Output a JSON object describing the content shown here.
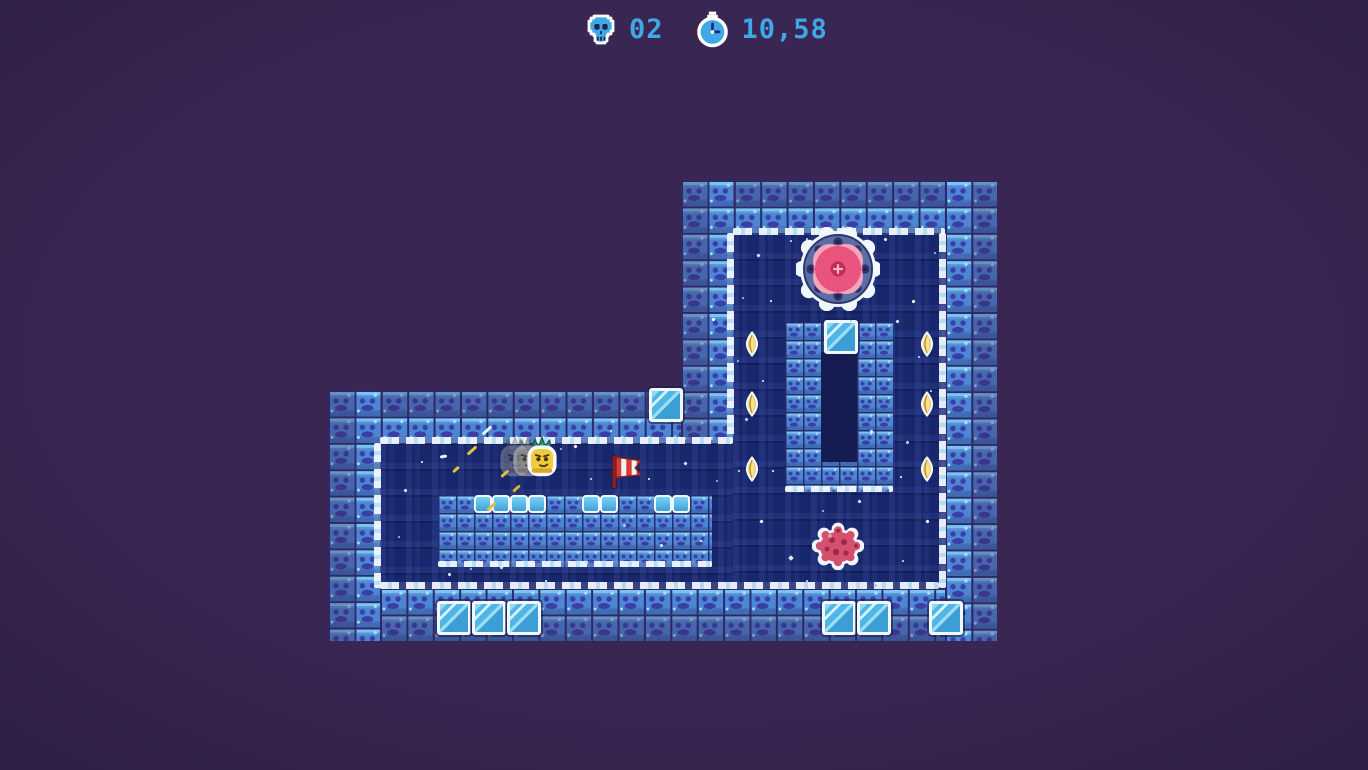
{
  "scene": {
    "width": 1368,
    "height": 770
  },
  "hud": {
    "skull_counter": {
      "icon": "skull-icon",
      "value": "02"
    },
    "timer": {
      "icon": "stopwatch-icon",
      "value": "10,58"
    },
    "text_color": "#3FA8E6"
  },
  "palette": {
    "outside_bg": "#3A2653",
    "room_bg": "#18266B",
    "tile_base": "#4D86D2",
    "tile_light": "#7CC4EE",
    "tile_speck": "#A6E0F6",
    "tile_mark": "#3B3EA6",
    "tile_outer_shade": "rgba(56,36,92,0.32)",
    "grout": "#2A2A70",
    "ice_white": "#F1F7FE",
    "glass_fill": "#4FB6E6",
    "glass_light": "#D6F2FC",
    "coin_gold": "#E7C652",
    "saw_ring": "#5A6EA8",
    "saw_pink": "#E8547E",
    "blob_body": "#D4506E",
    "player_body": "#F2CB3A",
    "flag_red": "#D93A34"
  },
  "level": {
    "rooms": [
      {
        "name": "right-room-interior",
        "x": 733,
        "y": 233,
        "w": 212,
        "h": 355
      },
      {
        "name": "left-room-interior",
        "x": 380,
        "y": 443,
        "w": 353,
        "h": 145
      }
    ],
    "walls": [
      {
        "name": "right-room-top-wall",
        "x": 681,
        "y": 180,
        "w": 316,
        "h": 53,
        "outer": "top"
      },
      {
        "name": "right-room-left-wall",
        "x": 681,
        "y": 180,
        "w": 52,
        "h": 263,
        "outer": "left"
      },
      {
        "name": "right-room-right-wall",
        "x": 945,
        "y": 180,
        "w": 52,
        "h": 461,
        "outer": "right"
      },
      {
        "name": "left-room-top-wall",
        "x": 328,
        "y": 390,
        "w": 353,
        "h": 53,
        "outer": "top"
      },
      {
        "name": "left-room-left-wall",
        "x": 328,
        "y": 390,
        "w": 52,
        "h": 251,
        "outer": "left"
      },
      {
        "name": "bottom-wall",
        "x": 380,
        "y": 588,
        "w": 565,
        "h": 53,
        "outer": "bottom"
      }
    ],
    "ice_edges": [
      {
        "x": 733,
        "y": 228,
        "w": 212,
        "h": 7,
        "dir": "h"
      },
      {
        "x": 380,
        "y": 437,
        "w": 353,
        "h": 7,
        "dir": "h"
      },
      {
        "x": 727,
        "y": 233,
        "w": 7,
        "h": 204,
        "dir": "v"
      },
      {
        "x": 374,
        "y": 443,
        "w": 7,
        "h": 145,
        "dir": "v"
      },
      {
        "x": 939,
        "y": 233,
        "w": 7,
        "h": 355,
        "dir": "v"
      },
      {
        "x": 380,
        "y": 582,
        "w": 559,
        "h": 7,
        "dir": "h"
      }
    ],
    "structures": [
      {
        "name": "inner-platform",
        "x": 438,
        "y": 495,
        "w": 274,
        "h": 72
      },
      {
        "name": "ring-structure",
        "x": 785,
        "y": 322,
        "w": 108,
        "h": 170
      }
    ],
    "ring_hollow": {
      "x": 821,
      "y": 352,
      "w": 36,
      "h": 110
    },
    "structure_ice_edges": [
      {
        "x": 438,
        "y": 561,
        "w": 274,
        "h": 6,
        "dir": "h"
      },
      {
        "x": 785,
        "y": 486,
        "w": 108,
        "h": 6,
        "dir": "h"
      }
    ],
    "mini_ice_blocks": {
      "y": 495,
      "size": 18,
      "xs": [
        474,
        492,
        510,
        528,
        582,
        600,
        654,
        672
      ]
    },
    "glass_blocks": [
      {
        "x": 649,
        "y": 388
      },
      {
        "x": 824,
        "y": 320
      },
      {
        "x": 437,
        "y": 601
      },
      {
        "x": 472,
        "y": 601
      },
      {
        "x": 507,
        "y": 601
      },
      {
        "x": 822,
        "y": 601
      },
      {
        "x": 857,
        "y": 601
      },
      {
        "x": 929,
        "y": 601
      }
    ],
    "coins": [
      {
        "x": 745,
        "y": 331
      },
      {
        "x": 745,
        "y": 391
      },
      {
        "x": 745,
        "y": 456
      },
      {
        "x": 920,
        "y": 331
      },
      {
        "x": 920,
        "y": 391
      },
      {
        "x": 920,
        "y": 456
      }
    ],
    "sparkles": [
      {
        "x": 757,
        "y": 254,
        "s": 3,
        "c": "#CFEBFF"
      },
      {
        "x": 742,
        "y": 297,
        "s": 2,
        "c": "#8FD4F2"
      },
      {
        "x": 712,
        "y": 318,
        "s": 3,
        "c": "#FFFFFF"
      },
      {
        "x": 762,
        "y": 380,
        "s": 2,
        "c": "#CFEBFF"
      },
      {
        "x": 745,
        "y": 418,
        "s": 3,
        "c": "#8FD4F2"
      },
      {
        "x": 738,
        "y": 470,
        "s": 2,
        "c": "#CFEBFF"
      },
      {
        "x": 760,
        "y": 520,
        "s": 3,
        "c": "#FFFFFF"
      },
      {
        "x": 789,
        "y": 556,
        "s": 4,
        "c": "#CFEBFF"
      },
      {
        "x": 822,
        "y": 510,
        "s": 2,
        "c": "#8FD4F2"
      },
      {
        "x": 858,
        "y": 500,
        "s": 3,
        "c": "#CFEBFF"
      },
      {
        "x": 900,
        "y": 476,
        "s": 2,
        "c": "#FFFFFF"
      },
      {
        "x": 906,
        "y": 441,
        "s": 3,
        "c": "#8FD4F2"
      },
      {
        "x": 918,
        "y": 356,
        "s": 2,
        "c": "#CFEBFF"
      },
      {
        "x": 912,
        "y": 300,
        "s": 3,
        "c": "#FFFFFF"
      },
      {
        "x": 934,
        "y": 252,
        "s": 2,
        "c": "#8FD4F2"
      },
      {
        "x": 884,
        "y": 238,
        "s": 3,
        "c": "#CFEBFF"
      },
      {
        "x": 806,
        "y": 238,
        "s": 2,
        "c": "#CFEBFF"
      },
      {
        "x": 737,
        "y": 360,
        "s": 2,
        "c": "#8FD4F2"
      },
      {
        "x": 896,
        "y": 320,
        "s": 3,
        "c": "#CFEBFF"
      },
      {
        "x": 926,
        "y": 520,
        "s": 3,
        "c": "#FFFFFF"
      },
      {
        "x": 902,
        "y": 560,
        "s": 2,
        "c": "#CFEBFF"
      },
      {
        "x": 874,
        "y": 584,
        "s": 3,
        "c": "#8FD4F2"
      },
      {
        "x": 806,
        "y": 580,
        "s": 2,
        "c": "#CFEBFF"
      },
      {
        "x": 772,
        "y": 470,
        "s": 2,
        "c": "#FFFFFF"
      },
      {
        "x": 790,
        "y": 240,
        "s": 2,
        "c": "#CFEBFF"
      },
      {
        "x": 850,
        "y": 320,
        "s": 2,
        "c": "#8FD4F2"
      },
      {
        "x": 870,
        "y": 430,
        "s": 3,
        "c": "#CFEBFF"
      },
      {
        "x": 930,
        "y": 390,
        "s": 2,
        "c": "#CFEBFF"
      },
      {
        "x": 770,
        "y": 300,
        "s": 2,
        "c": "#FFFFFF"
      },
      {
        "x": 404,
        "y": 489,
        "s": 3,
        "c": "#CFEBFF"
      },
      {
        "x": 398,
        "y": 536,
        "s": 2,
        "c": "#8FD4F2"
      },
      {
        "x": 421,
        "y": 461,
        "s": 2,
        "c": "#FFFFFF"
      },
      {
        "x": 448,
        "y": 573,
        "s": 3,
        "c": "#CFEBFF"
      },
      {
        "x": 470,
        "y": 568,
        "s": 2,
        "c": "#8FD4F2"
      },
      {
        "x": 500,
        "y": 566,
        "s": 3,
        "c": "#CFEBFF"
      },
      {
        "x": 545,
        "y": 580,
        "s": 2,
        "c": "#FFFFFF"
      },
      {
        "x": 585,
        "y": 561,
        "s": 3,
        "c": "#CFEBFF"
      },
      {
        "x": 622,
        "y": 584,
        "s": 2,
        "c": "#8FD4F2"
      },
      {
        "x": 660,
        "y": 544,
        "s": 3,
        "c": "#CFEBFF"
      },
      {
        "x": 648,
        "y": 478,
        "s": 2,
        "c": "#FFFFFF"
      },
      {
        "x": 623,
        "y": 524,
        "s": 3,
        "c": "#8FD4F2"
      },
      {
        "x": 590,
        "y": 478,
        "s": 2,
        "c": "#CFEBFF"
      },
      {
        "x": 574,
        "y": 445,
        "s": 3,
        "c": "#FFFFFF"
      },
      {
        "x": 610,
        "y": 430,
        "s": 2,
        "c": "#CFEBFF"
      },
      {
        "x": 560,
        "y": 448,
        "s": 2,
        "c": "#8FD4F2"
      },
      {
        "x": 684,
        "y": 462,
        "s": 3,
        "c": "#CFEBFF"
      },
      {
        "x": 700,
        "y": 540,
        "s": 2,
        "c": "#FFFFFF"
      },
      {
        "x": 716,
        "y": 480,
        "s": 2,
        "c": "#8FD4F2"
      }
    ],
    "sparks": [
      {
        "x": 466,
        "y": 449,
        "w": 12,
        "r": -42,
        "c": "#E4C039"
      },
      {
        "x": 500,
        "y": 472,
        "w": 10,
        "r": -42,
        "c": "#E4C039"
      },
      {
        "x": 512,
        "y": 487,
        "w": 9,
        "r": -42,
        "c": "#D8B22F"
      },
      {
        "x": 486,
        "y": 505,
        "w": 11,
        "r": -42,
        "c": "#E4C039"
      },
      {
        "x": 452,
        "y": 468,
        "w": 8,
        "r": -42,
        "c": "#E4C039"
      },
      {
        "x": 481,
        "y": 429,
        "w": 12,
        "r": -42,
        "c": "#EAF4FC"
      },
      {
        "x": 440,
        "y": 455,
        "w": 7,
        "r": -10,
        "c": "#EAF4FC"
      }
    ]
  },
  "entities": {
    "player": {
      "name": "player-pineapple",
      "x": 524,
      "y": 436,
      "w": 36,
      "h": 42
    },
    "player_trail": [
      {
        "dx": -27,
        "opacity": 0.35
      },
      {
        "dx": -14,
        "opacity": 0.55
      }
    ],
    "saw": {
      "name": "saw-blade-hazard",
      "cx": 838,
      "cy": 269,
      "r": 42
    },
    "spike_blob": {
      "name": "spike-blob-enemy",
      "cx": 838,
      "cy": 546
    },
    "flag": {
      "name": "checkpoint-flag",
      "x": 606,
      "y": 452
    }
  }
}
